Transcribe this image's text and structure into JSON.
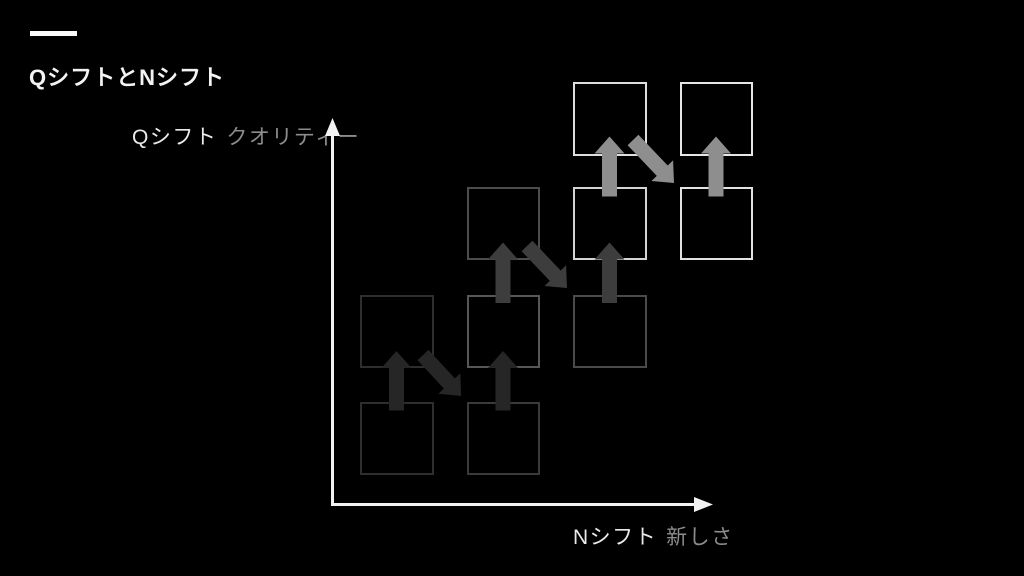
{
  "slide": {
    "title": "QシフトとNシフト",
    "background_color": "#000000",
    "accent_color": "#fafafa"
  },
  "axes": {
    "color": "#f2f2f2",
    "y": {
      "label_primary": "Qシフト",
      "label_secondary": "クオリティー"
    },
    "x": {
      "label_primary": "Nシフト",
      "label_secondary": "新しさ"
    }
  },
  "diagram": {
    "grid": {
      "col_lefts": [
        360,
        466.5,
        573,
        679.5
      ],
      "row_tops": [
        82,
        186.5,
        294.5,
        401.5
      ],
      "square_size": 73.5
    },
    "squares": [
      {
        "name": "square-row1-col3",
        "col": 2,
        "row": 0,
        "border_color": "#dedede"
      },
      {
        "name": "square-row1-col4",
        "col": 3,
        "row": 0,
        "border_color": "#e6e6e6"
      },
      {
        "name": "square-row2-col2",
        "col": 1,
        "row": 1,
        "border_color": "#4c4c4c"
      },
      {
        "name": "square-row2-col3",
        "col": 2,
        "row": 1,
        "border_color": "#d4d4d4"
      },
      {
        "name": "square-row2-col4",
        "col": 3,
        "row": 1,
        "border_color": "#e2e2e2"
      },
      {
        "name": "square-row3-col1",
        "col": 0,
        "row": 2,
        "border_color": "#2e2e2e"
      },
      {
        "name": "square-row3-col2",
        "col": 1,
        "row": 2,
        "border_color": "#575757"
      },
      {
        "name": "square-row3-col3",
        "col": 2,
        "row": 2,
        "border_color": "#4a4a4a"
      },
      {
        "name": "square-row4-col1",
        "col": 0,
        "row": 3,
        "border_color": "#2e2e2e"
      },
      {
        "name": "square-row4-col2",
        "col": 1,
        "row": 3,
        "border_color": "#3a3a3a"
      }
    ],
    "arrows": [
      {
        "name": "q-shift-arrow-1",
        "type": "up",
        "cx": 396.5,
        "y_base": 410.5,
        "y_tip": 351,
        "color": "#262626"
      },
      {
        "name": "n-shift-arrow-1",
        "type": "diagonal",
        "x1": 423,
        "y1": 355,
        "x2": 461,
        "y2": 396,
        "color": "#262626"
      },
      {
        "name": "q-shift-arrow-2",
        "type": "up",
        "cx": 503,
        "y_base": 410.5,
        "y_tip": 351,
        "color": "#262626"
      },
      {
        "name": "q-shift-arrow-3",
        "type": "up",
        "cx": 503,
        "y_base": 303,
        "y_tip": 242.5,
        "color": "#3d3d3d"
      },
      {
        "name": "n-shift-arrow-2",
        "type": "diagonal",
        "x1": 527,
        "y1": 246,
        "x2": 567,
        "y2": 288,
        "color": "#3d3d3d"
      },
      {
        "name": "q-shift-arrow-4",
        "type": "up",
        "cx": 609.5,
        "y_base": 303,
        "y_tip": 242.5,
        "color": "#3d3d3d"
      },
      {
        "name": "q-shift-arrow-5",
        "type": "up",
        "cx": 609.5,
        "y_base": 196.5,
        "y_tip": 136.5,
        "color": "#8e8e8e"
      },
      {
        "name": "n-shift-arrow-3",
        "type": "diagonal",
        "x1": 633,
        "y1": 140,
        "x2": 674,
        "y2": 183,
        "color": "#8e8e8e"
      },
      {
        "name": "q-shift-arrow-6",
        "type": "up",
        "cx": 716,
        "y_base": 196.5,
        "y_tip": 136.5,
        "color": "#8e8e8e"
      }
    ],
    "arrow_geometry": {
      "shaft_width": 15,
      "head_width": 30,
      "head_length": 17
    }
  }
}
